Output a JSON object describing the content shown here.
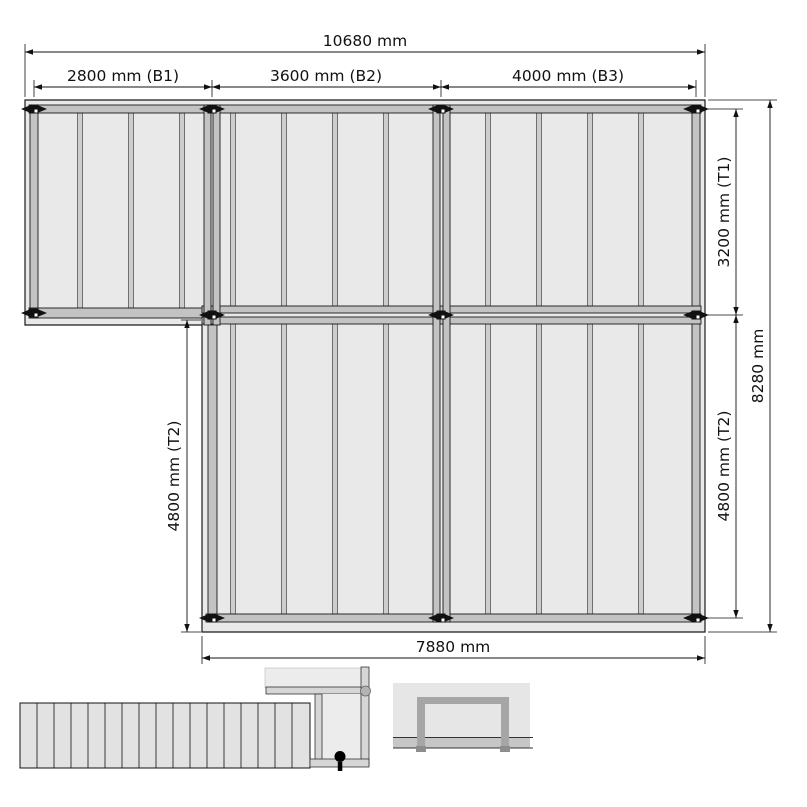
{
  "plan": {
    "dim_overall_width": "10680 mm",
    "dim_bay_1": "2800 mm (B1)",
    "dim_bay_2": "3600 mm (B2)",
    "dim_bay_3": "4000 mm (B3)",
    "dim_depth_top_right": "3200 mm (T1)",
    "dim_depth_bottom_right": "4800 mm (T2)",
    "dim_overall_depth": "8280 mm",
    "dim_depth_left": "4800 mm (T2)",
    "dim_bottom_width": "7880 mm"
  },
  "colors": {
    "deck": "#e9e9e9",
    "beam": "#c3c3c3",
    "joist": "#cdcdcd",
    "post": "#111111",
    "line": "#1a1a1a",
    "slat": "#e2e2e2",
    "frame_dark": "#a6a6a6",
    "ground": "#c6c6c6"
  }
}
